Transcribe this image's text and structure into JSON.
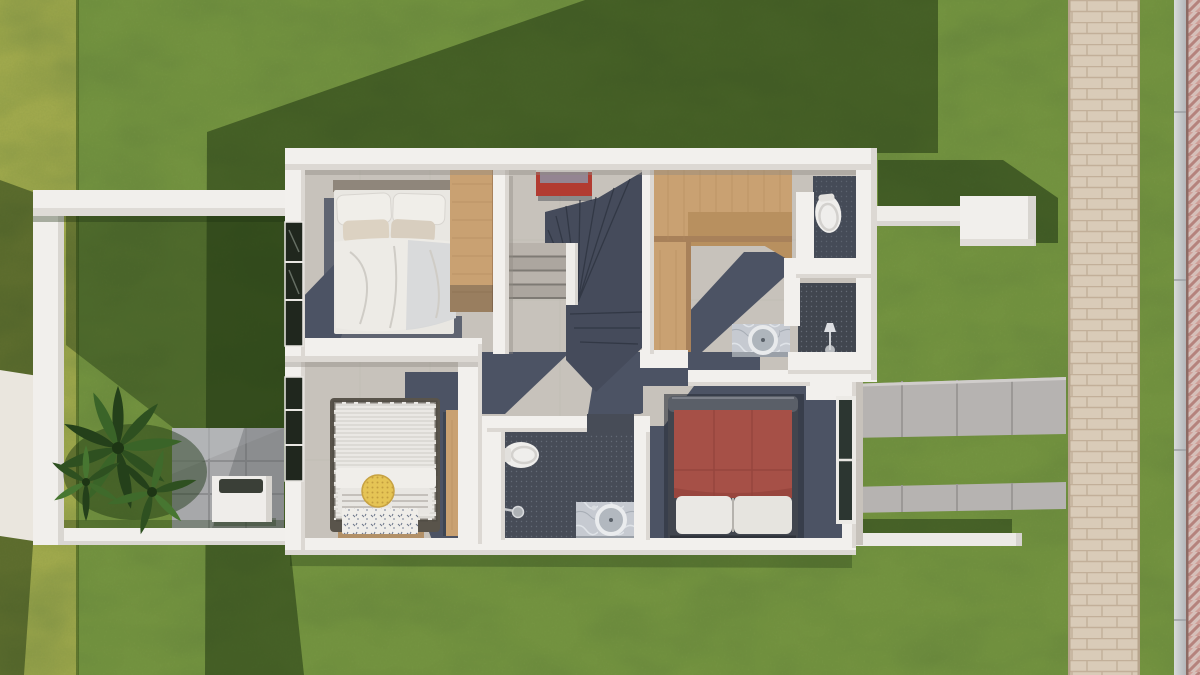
{
  "scene": {
    "title": "aerial-3d-render-upper-floor-plan",
    "colors": {
      "grass_base": "#72923f",
      "grass_light": "#9fa84c",
      "shadow_green": "#1c3110",
      "wall_white": "#f2f0ed",
      "wall_face": "#dcd8d3",
      "floor_light": "#c7c2bb",
      "floor_navy": "#4c5364",
      "stair_dark": "#454b5b",
      "tile_dark": "#474c57",
      "wood_light": "#c9a172",
      "wood_dark": "#a8815a",
      "bed_red": "#a65047",
      "bed_frame_dark": "#41454e",
      "pillow_yellow": "#e5c455",
      "painting_red": "#b23b31",
      "walkway_paver": "#d9cbb8",
      "herringbone_pink": "#d6c0ba",
      "curb_gray": "#c3c6c8",
      "concrete_slab": "#b6b3b1",
      "path_light": "#eae6de",
      "marble": "#c6cad1",
      "linen": "#eae8e4",
      "glass_dark": "#2c3631",
      "plant_green": "#315422"
    }
  },
  "rooms": [
    {
      "name": "bedroom-top-left",
      "furniture": [
        "double-bed-white",
        "wardrobe-wood",
        "window"
      ]
    },
    {
      "name": "stair-hall",
      "furniture": [
        "winder-staircase",
        "red-painting"
      ]
    },
    {
      "name": "walk-in-closet",
      "furniture": [
        "l-shaped-wood-closet"
      ]
    },
    {
      "name": "wc-top-right",
      "furniture": [
        "toilet"
      ]
    },
    {
      "name": "bathroom-mid-right",
      "furniture": [
        "vanity-round-basin",
        "floor-lamp"
      ]
    },
    {
      "name": "bedroom-bottom-left",
      "furniture": [
        "double-bed-striped",
        "yellow-round-pillow",
        "desk-wood",
        "window"
      ]
    },
    {
      "name": "bathroom-bottom-center",
      "furniture": [
        "toilet",
        "shower-head",
        "vanity-round-basin"
      ]
    },
    {
      "name": "bedroom-bottom-right",
      "furniture": [
        "double-bed-red",
        "glass-door"
      ]
    }
  ],
  "exterior": {
    "features": [
      "lawn",
      "cast-shadow",
      "side-yard-wall",
      "palm-plant",
      "white-planter-box",
      "gray-patio-tiles",
      "light-garden-path",
      "concrete-slab-bands",
      "white-garden-beam",
      "white-entry-canopy-box",
      "paver-walkway",
      "curb",
      "herringbone-pavement"
    ]
  }
}
